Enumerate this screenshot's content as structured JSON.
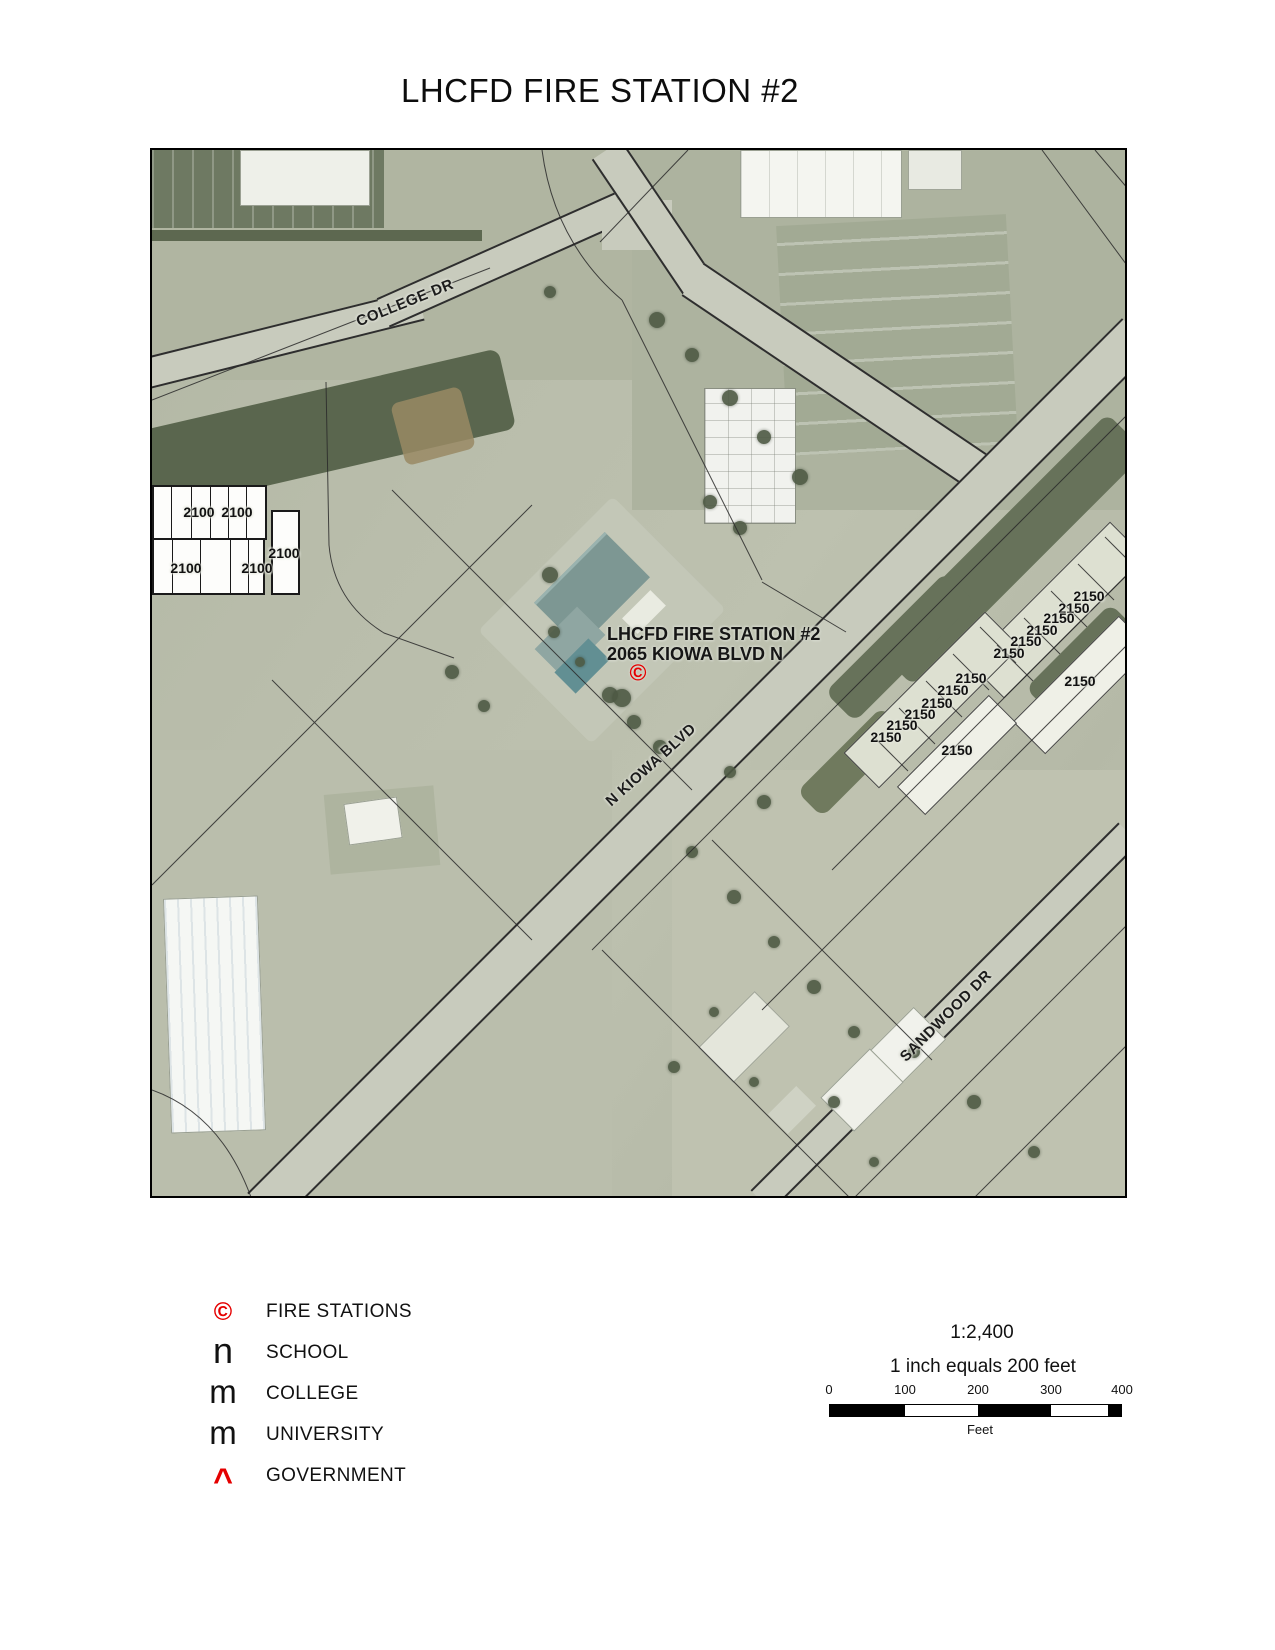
{
  "title": "LHCFD FIRE STATION #2",
  "map": {
    "station": {
      "line1": "LHCFD FIRE STATION #2",
      "line2": "2065 KIOWA BLVD N",
      "marker_symbol": "©"
    },
    "streets": [
      {
        "text": "COLLEGE DR",
        "x": 253,
        "y": 153,
        "angle": -22
      },
      {
        "text": "N KIOWA BLVD",
        "x": 499,
        "y": 615,
        "angle": -42
      },
      {
        "text": "SANDWOOD DR",
        "x": 794,
        "y": 866,
        "angle": -45
      }
    ],
    "parcel_labels": [
      {
        "text": "2100",
        "x": 47,
        "y": 362
      },
      {
        "text": "2100",
        "x": 85,
        "y": 362
      },
      {
        "text": "2100",
        "x": 132,
        "y": 403
      },
      {
        "text": "2100",
        "x": 34,
        "y": 418
      },
      {
        "text": "2100",
        "x": 105,
        "y": 418
      },
      {
        "text": "2150",
        "x": 937,
        "y": 446
      },
      {
        "text": "2150",
        "x": 922,
        "y": 458
      },
      {
        "text": "2150",
        "x": 907,
        "y": 468
      },
      {
        "text": "2150",
        "x": 890,
        "y": 480
      },
      {
        "text": "2150",
        "x": 874,
        "y": 491
      },
      {
        "text": "2150",
        "x": 857,
        "y": 503
      },
      {
        "text": "2150",
        "x": 928,
        "y": 531
      },
      {
        "text": "2150",
        "x": 819,
        "y": 528
      },
      {
        "text": "2150",
        "x": 801,
        "y": 540
      },
      {
        "text": "2150",
        "x": 785,
        "y": 553
      },
      {
        "text": "2150",
        "x": 768,
        "y": 564
      },
      {
        "text": "2150",
        "x": 750,
        "y": 575
      },
      {
        "text": "2150",
        "x": 734,
        "y": 587
      },
      {
        "text": "2150",
        "x": 805,
        "y": 600
      }
    ]
  },
  "legend": {
    "items": [
      {
        "symbol": "©",
        "label": "FIRE STATIONS",
        "color": "#e50000"
      },
      {
        "symbol": "n",
        "label": "SCHOOL",
        "color": "#111111"
      },
      {
        "symbol": "m",
        "label": "COLLEGE",
        "color": "#111111"
      },
      {
        "symbol": "m",
        "label": "UNIVERSITY",
        "color": "#111111"
      },
      {
        "symbol": "^",
        "label": "GOVERNMENT",
        "color": "#e50000"
      }
    ]
  },
  "scale": {
    "ratio": "1:2,400",
    "equivalence": "1 inch equals 200 feet",
    "ticks": [
      "0",
      "100",
      "200",
      "300",
      "400"
    ],
    "unit": "Feet"
  }
}
